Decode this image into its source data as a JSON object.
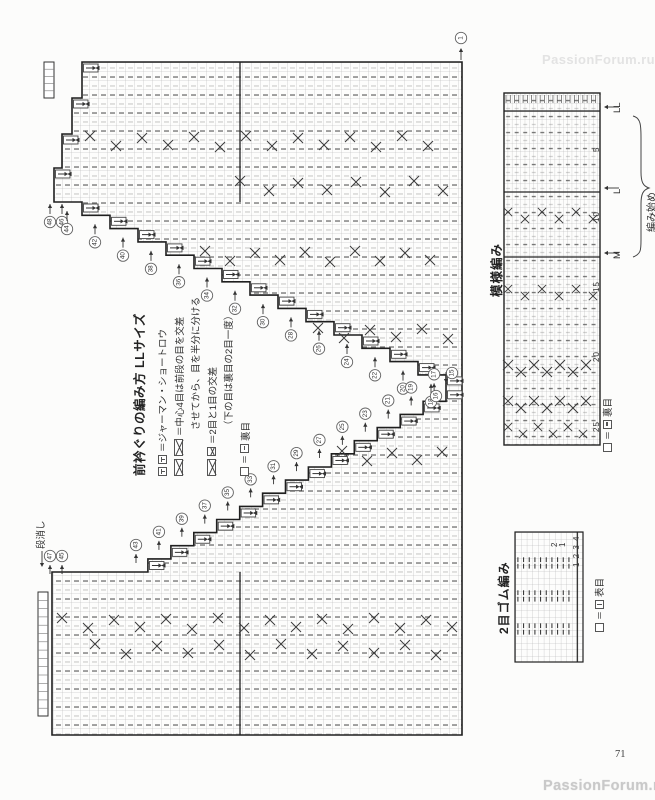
{
  "page": {
    "number": "71",
    "watermark": "PassionForum.ru"
  },
  "instructions": {
    "title": "前衿ぐりの編み方 LLサイズ",
    "german_short_row_label": "＝ジャーマン・ショートロウ",
    "center_cross_label": "＝中心4目は前段の目を交差",
    "center_cross_label2": "させてから、目を半分に分ける",
    "two_one_cross_label": "＝2目と1目の交差",
    "two_one_cross_label2": "（下の目は裏目の2目一度）",
    "purl_label": "裏目"
  },
  "main_chart": {
    "dankeshi_label": "段消し",
    "top_corner_marker": "1",
    "upper_stair_markers": [
      "48",
      "46",
      "44",
      "42",
      "40",
      "38",
      "36",
      "34",
      "32",
      "30",
      "28",
      "26",
      "24",
      "22",
      "20",
      "18"
    ],
    "lower_stair_markers": [
      "47",
      "45",
      "43",
      "41",
      "39",
      "37",
      "35",
      "33",
      "31",
      "29",
      "27",
      "25",
      "23",
      "21",
      "19",
      "17"
    ],
    "apex_markers": [
      "16",
      "15"
    ]
  },
  "pattern_chart": {
    "title": "模様編み",
    "size_labels": [
      "LL",
      "L",
      "M"
    ],
    "start_label": "編み始め",
    "row_numbers": [
      "5",
      "10",
      "15",
      "20",
      "25"
    ],
    "legend_label": "裏目"
  },
  "rib_chart": {
    "title": "2目ゴム編み",
    "row_numbers": [
      "2",
      "1"
    ],
    "stitch_numbers": "1 2 3 4",
    "legend_label": "表目"
  }
}
